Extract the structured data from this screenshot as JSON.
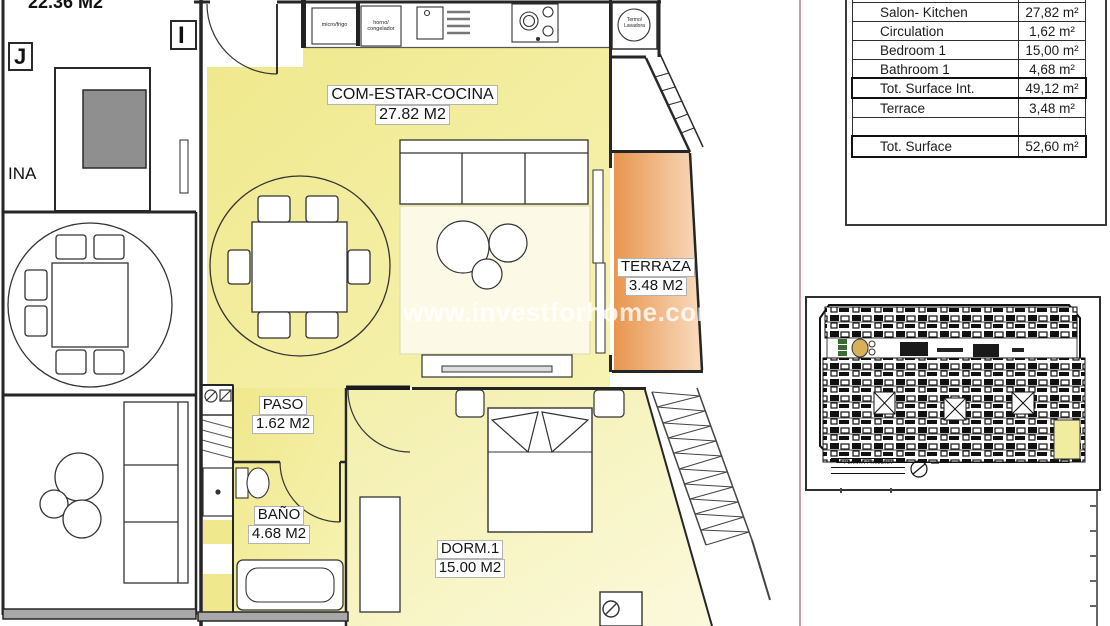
{
  "plan": {
    "rooms": {
      "salon": {
        "name": "COM-ESTAR-COCINA",
        "area": "27.82 M2"
      },
      "terraza": {
        "name": "TERRAZA",
        "area": "3.48 M2"
      },
      "paso": {
        "name": "PASO",
        "area": "1.62 M2"
      },
      "bano": {
        "name": "BAÑO",
        "area": "4.68 M2"
      },
      "dorm": {
        "name": "DORM.1",
        "area": "15.00 M2"
      }
    },
    "neighbor_area_label": "22.36 M2",
    "partial_label": "INA",
    "grid": {
      "j": "J",
      "i": "I"
    },
    "appliances": {
      "micro": "micro/frigo",
      "horno1": "horno/",
      "horno2": "congelador",
      "termo1": "Termo/",
      "termo2": "Lavadora"
    },
    "watermark": "www.investforhome.com"
  },
  "surface_table": {
    "rows": [
      {
        "label": "Salon- Kitchen",
        "value": "27,82 m²"
      },
      {
        "label": "Circulation",
        "value": "1,62 m²"
      },
      {
        "label": "Bedroom 1",
        "value": "15,00 m²"
      },
      {
        "label": "Bathroom 1",
        "value": "4,68 m²"
      },
      {
        "label": "Tot. Surface Int.",
        "value": "49,12 m²"
      },
      {
        "label": "Terrace",
        "value": "3,48 m²"
      },
      {
        "label": "",
        "value": ""
      },
      {
        "label": "Tot. Surface",
        "value": "52,60 m²"
      }
    ]
  },
  "keyplan": {
    "caption": "PLANTA PRIMERA"
  },
  "colors": {
    "apartment_fill": "#f0e98e",
    "bedroom_fill": "#f6f3bb",
    "terrace_fill": "#eb9b55",
    "highlight_unit": "#f0eda0",
    "separator_line": "#c99ea6",
    "walls": "#262626"
  }
}
